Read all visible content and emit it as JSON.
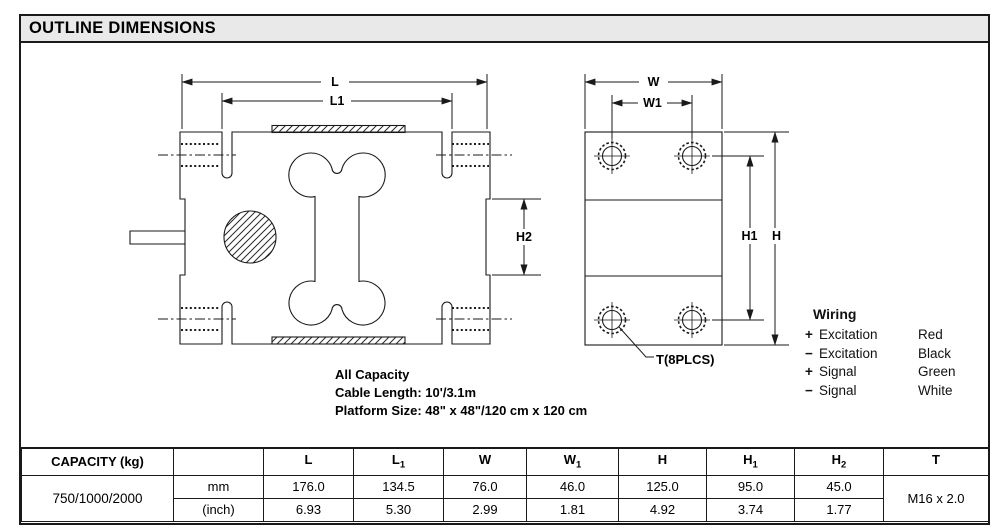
{
  "title": "OUTLINE DIMENSIONS",
  "colors": {
    "title_bar_bg": "#e9e9e9",
    "line": "#1a1a1a"
  },
  "drawing": {
    "dims": {
      "l": "L",
      "l1": "L1",
      "w": "W",
      "w1": "W1",
      "h": "H",
      "h1": "H1",
      "h2": "H2"
    },
    "t_callout": "T(8PLCS)",
    "notes": [
      "All Capacity",
      "Cable Length: 10'/3.1m",
      "Platform Size: 48\" x 48\"/120 cm x 120 cm"
    ]
  },
  "wiring": {
    "heading": "Wiring",
    "rows": [
      {
        "sign": "+",
        "label": "Excitation",
        "color": "Red"
      },
      {
        "sign": "−",
        "label": "Excitation",
        "color": "Black"
      },
      {
        "sign": "+",
        "label": "Signal",
        "color": "Green"
      },
      {
        "sign": "−",
        "label": "Signal",
        "color": "White"
      }
    ]
  },
  "table": {
    "capacity_header": "CAPACITY (kg)",
    "unit_header": "",
    "capacity_value": "750/1000/2000",
    "columns": [
      {
        "base": "L",
        "sub": ""
      },
      {
        "base": "L",
        "sub": "1"
      },
      {
        "base": "W",
        "sub": ""
      },
      {
        "base": "W",
        "sub": "1"
      },
      {
        "base": "H",
        "sub": ""
      },
      {
        "base": "H",
        "sub": "1"
      },
      {
        "base": "H",
        "sub": "2"
      },
      {
        "base": "T",
        "sub": ""
      }
    ],
    "rows": [
      {
        "unit": "mm",
        "values": [
          "176.0",
          "134.5",
          "76.0",
          "46.0",
          "125.0",
          "95.0",
          "45.0"
        ]
      },
      {
        "unit": "(inch)",
        "values": [
          "6.93",
          "5.30",
          "2.99",
          "1.81",
          "4.92",
          "3.74",
          "1.77"
        ]
      }
    ],
    "thread": "M16 x 2.0"
  }
}
